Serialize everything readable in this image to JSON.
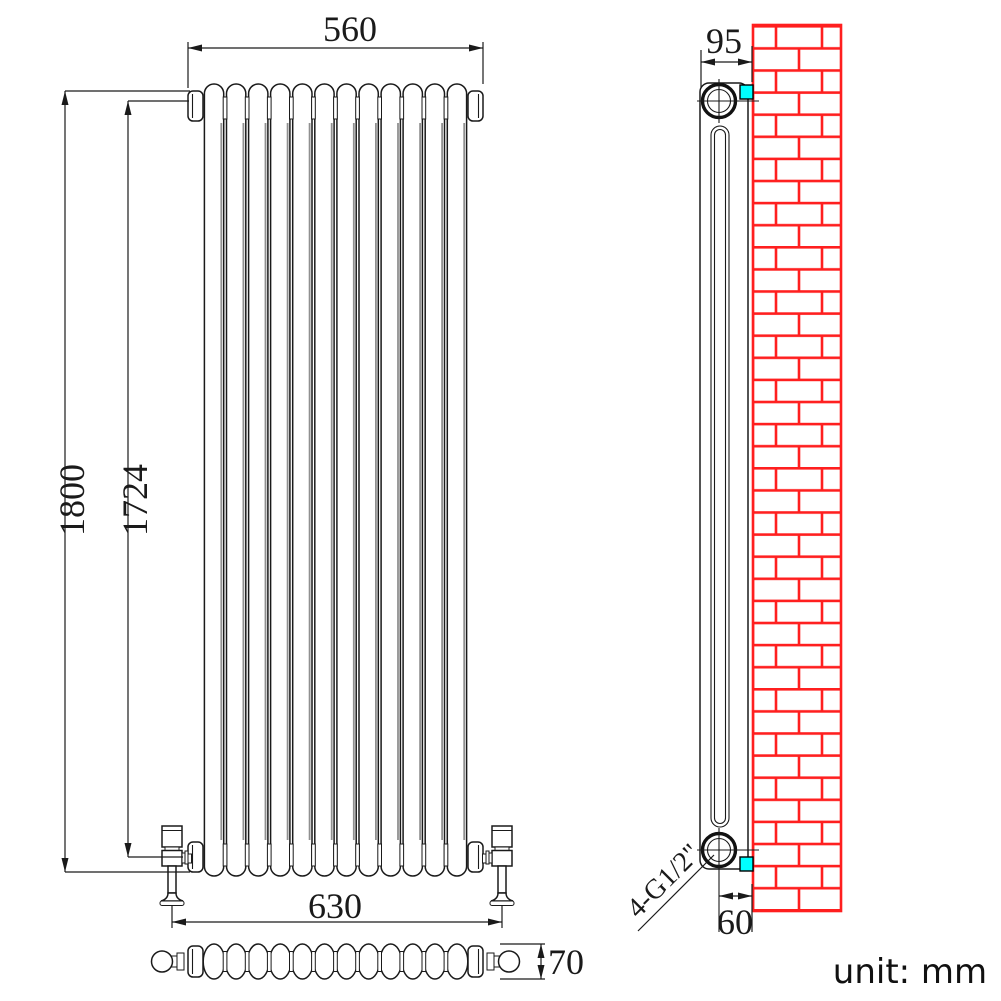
{
  "drawing": {
    "unit_label": "unit: mm",
    "dimensions": {
      "width": "560",
      "height": "1800",
      "tapping_centres": "1724",
      "valve_span": "630",
      "depth": "70",
      "side_width": "95",
      "wall_distance": "60",
      "thread": "4-G1/2\""
    },
    "colors": {
      "line": "#1a1a1a",
      "brick_red": "#ff1f1f",
      "bracket_cyan": "#00ffff",
      "column_shade": "#909090",
      "background": "#ffffff"
    },
    "front_view": {
      "columns": 12
    },
    "plan_view": {
      "columns": 12
    },
    "side_view": {
      "brackets": 2,
      "tappings": 2
    }
  }
}
